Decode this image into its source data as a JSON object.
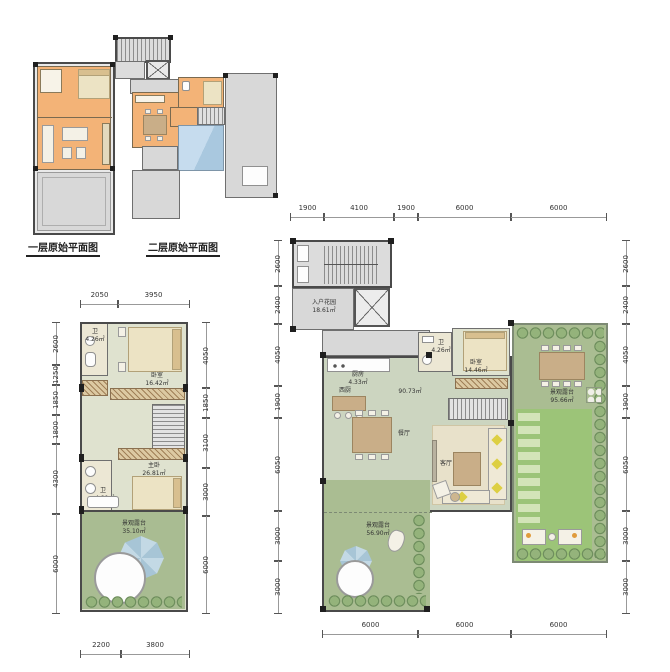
{
  "captions": {
    "floor1": "一层原始平面图",
    "floor2": "二层原始平面图"
  },
  "plan3": {
    "dims_top": [
      "2050",
      "3950"
    ],
    "dims_left": [
      "2600",
      "1250",
      "1850",
      "1800",
      "4300",
      "6000"
    ],
    "dims_right": [
      "4050",
      "1850",
      "3100",
      "3000",
      "6000"
    ],
    "dims_bottom": [
      "2200",
      "3800"
    ],
    "rooms": {
      "bath_top": {
        "name": "卫",
        "area": "4.26㎡"
      },
      "bedroom": {
        "name": "卧室",
        "area": "16.42㎡"
      },
      "master": {
        "name": "主卧",
        "area": "26.81㎡"
      },
      "bath_bottom": {
        "name": "卫",
        "area": "4.80㎡"
      },
      "terrace": {
        "name": "景观露台",
        "area": "35.10㎡"
      }
    }
  },
  "plan4": {
    "dims_top": [
      "1900",
      "4100",
      "1900",
      "6000",
      "6000"
    ],
    "dims_left": [
      "2600",
      "2400",
      "4050",
      "1900",
      "6050",
      "3000",
      "3000"
    ],
    "dims_right": [
      "2600",
      "2400",
      "4050",
      "1900",
      "6050",
      "3000",
      "3000"
    ],
    "dims_bottom": [
      "6000",
      "6000",
      "6000"
    ],
    "rooms": {
      "entry_garden": {
        "name": "入户花园",
        "area": "18.61㎡"
      },
      "kitchen": {
        "name": "厨房",
        "area": "4.33㎡"
      },
      "west_kitchen": {
        "name": "西厨"
      },
      "hall": {
        "area": "90.73㎡"
      },
      "dining": {
        "name": "餐厅"
      },
      "bath": {
        "name": "卫",
        "area": "4.26㎡"
      },
      "bedroom": {
        "name": "卧室",
        "area": "14.46㎡"
      },
      "living": {
        "name": "客厅"
      },
      "terrace_sw": {
        "name": "景观露台",
        "area": "56.90㎡"
      },
      "terrace_e": {
        "name": "景观露台",
        "area": "95.66㎡"
      }
    }
  },
  "colors": {
    "orange_room": "#f3b377",
    "terrace_gray": "#d8d8d8",
    "glass_blue": "#b9d5e9",
    "floor_sage": "#ccd5c0",
    "terrace_green": "#a9bc92",
    "lawn_green": "#9cc478",
    "wall": "#4a4a4a"
  }
}
